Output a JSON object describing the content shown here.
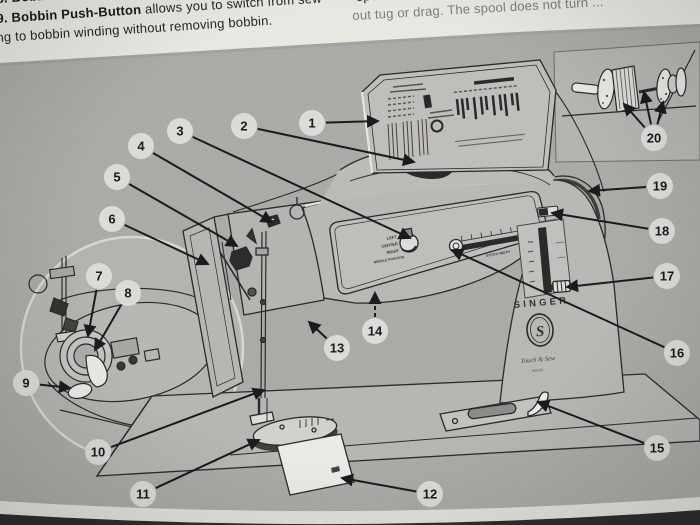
{
  "page": {
    "top_text_left": {
      "l1_num": "8.",
      "l1_bold": "Bobbin Latch",
      "l1_rest": "flips up ...",
      "l2_num": "9.",
      "l2_bold": "Bobbin Push-Button",
      "l2_rest": "allows you to switch from sew-",
      "l3": "ng to bobbin winding without removing bobbin."
    },
    "top_text_right": {
      "l1": "spool ...",
      "l2": "out tug or drag. The spool does not turn ..."
    }
  },
  "diagram": {
    "machine_labels": {
      "brand": "SINGER",
      "logo_monogram": "S",
      "script_text": "Touch & Sew",
      "model_text": "MODEL",
      "needle_left": "LEFT",
      "needle_center": "CENTER",
      "needle_right": "RIGHT",
      "needle_position": "NEEDLE POSITION",
      "stitch_width": "STITCH WIDTH"
    },
    "callouts": [
      {
        "n": "1",
        "cx": 312,
        "cy": 123,
        "tx": 378,
        "ty": 121
      },
      {
        "n": "2",
        "cx": 244,
        "cy": 126,
        "tx": 414,
        "ty": 162
      },
      {
        "n": "3",
        "cx": 180,
        "cy": 131,
        "tx": 410,
        "ty": 238
      },
      {
        "n": "4",
        "cx": 141,
        "cy": 146,
        "tx": 272,
        "ty": 222
      },
      {
        "n": "5",
        "cx": 117,
        "cy": 177,
        "tx": 237,
        "ty": 246
      },
      {
        "n": "6",
        "cx": 112,
        "cy": 219,
        "tx": 208,
        "ty": 264
      },
      {
        "n": "7",
        "cx": 99,
        "cy": 276,
        "tx": 88,
        "ty": 336
      },
      {
        "n": "8",
        "cx": 128,
        "cy": 293,
        "tx": 95,
        "ty": 350
      },
      {
        "n": "9",
        "cx": 26,
        "cy": 383,
        "tx": 70,
        "ty": 388
      },
      {
        "n": "10",
        "cx": 98,
        "cy": 452,
        "tx": 264,
        "ty": 390
      },
      {
        "n": "11",
        "cx": 143,
        "cy": 494,
        "tx": 259,
        "ty": 440
      },
      {
        "n": "12",
        "cx": 430,
        "cy": 494,
        "tx": 342,
        "ty": 478
      },
      {
        "n": "13",
        "cx": 337,
        "cy": 348,
        "tx": 309,
        "ty": 322
      },
      {
        "n": "14",
        "cx": 375,
        "cy": 331,
        "tx": 375,
        "ty": 293,
        "dashed": true
      },
      {
        "n": "15",
        "cx": 657,
        "cy": 448,
        "tx": 538,
        "ty": 402
      },
      {
        "n": "16",
        "cx": 677,
        "cy": 353,
        "tx": 452,
        "ty": 250
      },
      {
        "n": "17",
        "cx": 667,
        "cy": 276,
        "tx": 567,
        "ty": 287
      },
      {
        "n": "18",
        "cx": 662,
        "cy": 231,
        "tx": 552,
        "ty": 213
      },
      {
        "n": "19",
        "cx": 660,
        "cy": 186,
        "tx": 589,
        "ty": 191
      },
      {
        "n": "20",
        "cx": 654,
        "cy": 138,
        "targets": [
          [
            624,
            104
          ],
          [
            644,
            92
          ],
          [
            663,
            102
          ]
        ]
      }
    ]
  },
  "colors": {
    "bg": "#b3b1ad",
    "paper": "#e9e7e2",
    "ink": "#1c1b19",
    "line": "#2b2a28",
    "callout_fill": "#dcdbd7",
    "white_part": "#eceae6",
    "dark_strip": "#2f2e2c"
  }
}
